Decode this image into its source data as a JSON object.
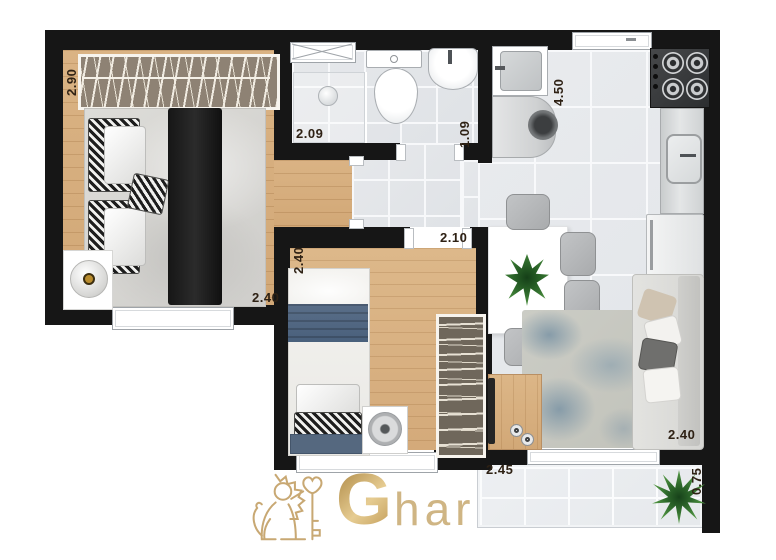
{
  "plan_type": "apartment-floor-plan",
  "dimensions": {
    "bedroom1_closet": "2.90",
    "bedroom1_width": "2.40",
    "bathroom_width": "2.09",
    "bathroom_depth": "1.09",
    "kitchen_length": "4.50",
    "bedroom2_length": "2.40",
    "bedroom2_width": "2.10",
    "living_width": "2.40",
    "balcony_length": "2.45",
    "balcony_depth": "0.75"
  },
  "watermark": {
    "brand_initial": "G",
    "brand_rest": "har"
  },
  "colors": {
    "wall": "#161616",
    "wood_floor": "#d7ad7e",
    "tile_floor": "#e8eaed",
    "bed2_blue": "#52657f",
    "brand_gold": "#c7a66e",
    "label_text": "#2e2114",
    "plant_green": "#3e7d3a"
  }
}
